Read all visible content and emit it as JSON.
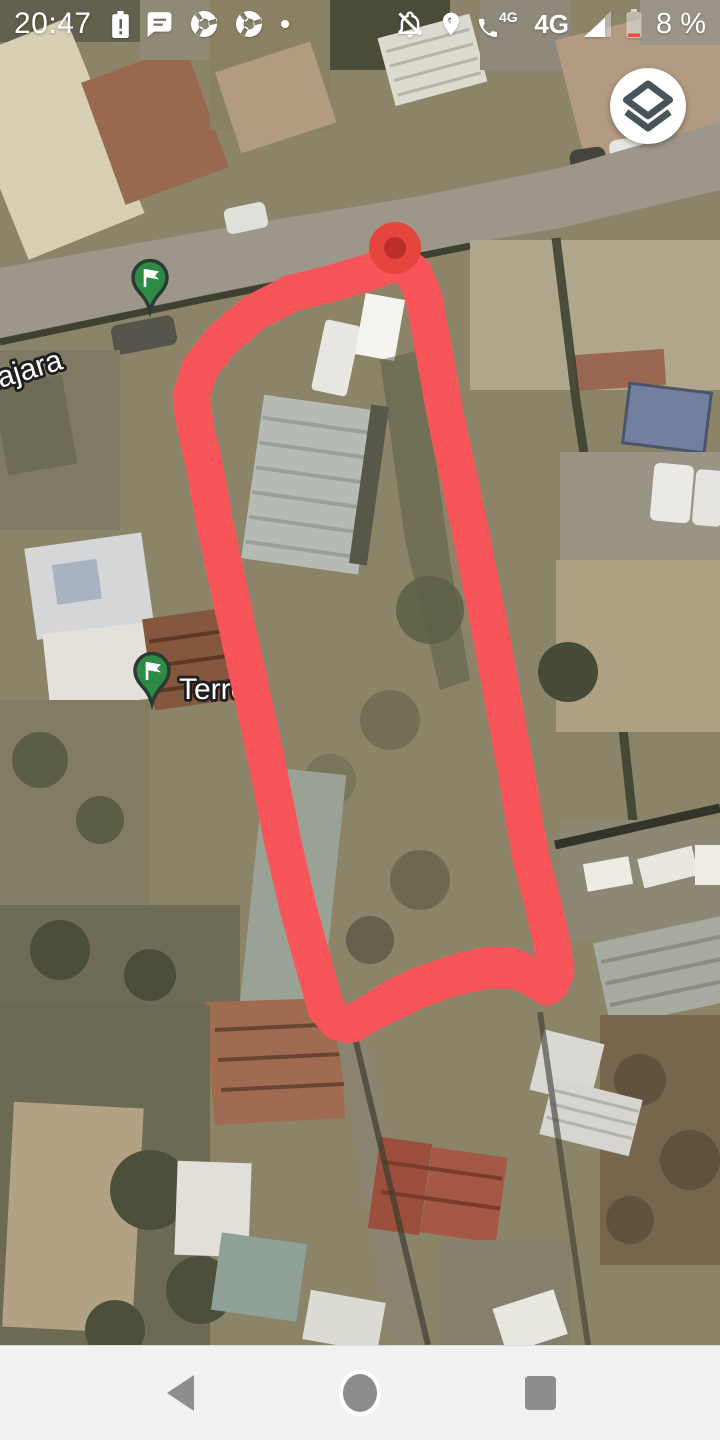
{
  "status_bar": {
    "time": "20:47",
    "left_icons": [
      "battery-alert",
      "sms-message",
      "chrome",
      "chrome",
      "notification-dot"
    ],
    "right_icons": [
      "notifications-off",
      "location",
      "volte-4g",
      "signal-strength",
      "battery-low"
    ],
    "volte_label": "4G",
    "network_label": "4G",
    "battery_percent": "8 %"
  },
  "map": {
    "street_label": "lajara",
    "place_label": "Terre",
    "markers": {
      "red_dot_marker": 1,
      "green_flag_markers": 2
    }
  },
  "controls": {
    "layers_button_icon": "layers"
  },
  "nav_bar": {
    "icons": [
      "back",
      "home",
      "overview"
    ]
  },
  "colors": {
    "annotation_red": "#f8555a",
    "pin_red": "#e6453e",
    "pin_red_dark": "#bb2f2a",
    "flag_green": "#2e8b46",
    "nav_background": "#f1f1f1",
    "nav_icon_gray": "#8d8d8d",
    "status_icon_white": "#ffffff"
  }
}
